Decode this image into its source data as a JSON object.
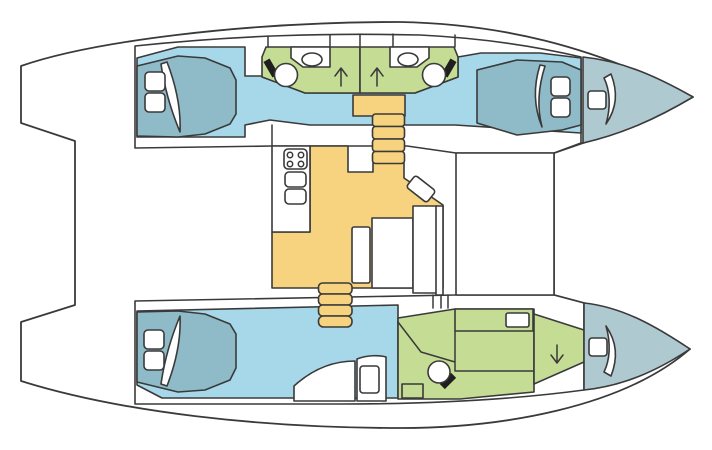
{
  "canvas": {
    "width": 712,
    "height": 450,
    "background": "#ffffff"
  },
  "diagram": {
    "type": "floor-plan",
    "subject": "Catamaran yacht interior layout, top-down view, bows pointing right",
    "colors": {
      "outline": "#3a3a3a",
      "hull_white": "#ffffff",
      "floor_blue": "#a7d8e9",
      "berth_teal": "#8fbac8",
      "bow_gray": "#afc9d1",
      "head_green": "#c5dc95",
      "saloon_yellow": "#f7d37f",
      "black": "#1f1f1f"
    },
    "port_hull": {
      "position": "top",
      "aft_cabin": {
        "type": "double-berth cabin",
        "pillows": 2
      },
      "aft_head": {
        "fixtures": [
          "toilet",
          "sink"
        ],
        "arrow": "up"
      },
      "forward_head": {
        "fixtures": [
          "toilet",
          "sink"
        ],
        "arrow": "up"
      },
      "forward_cabin": {
        "type": "double-berth cabin",
        "pillows": 2
      },
      "bow_locker": {
        "hatches": 1
      }
    },
    "starboard_hull": {
      "position": "bottom",
      "aft_cabin": {
        "type": "double-berth cabin",
        "pillows": 2
      },
      "lounge": {
        "seats": 2
      },
      "forward_head": {
        "fixtures": [
          "toilet",
          "sink",
          "vanity-counter"
        ],
        "arrow": "down"
      },
      "bow_locker": {
        "hatches": 1
      }
    },
    "saloon": {
      "galley": {
        "stove_burners": 4,
        "sinks": 2
      },
      "furniture": [
        "nav-seat",
        "side-seat",
        "table",
        "settee"
      ],
      "companionways": [
        {
          "hull": "port",
          "steps": 4,
          "landing": true
        },
        {
          "hull": "starboard",
          "steps": 4,
          "landing": false
        }
      ]
    },
    "arrows": [
      {
        "location": "port-aft-head",
        "direction": "up"
      },
      {
        "location": "port-forward-head",
        "direction": "up"
      },
      {
        "location": "starboard-forward-head",
        "direction": "down"
      }
    ]
  }
}
